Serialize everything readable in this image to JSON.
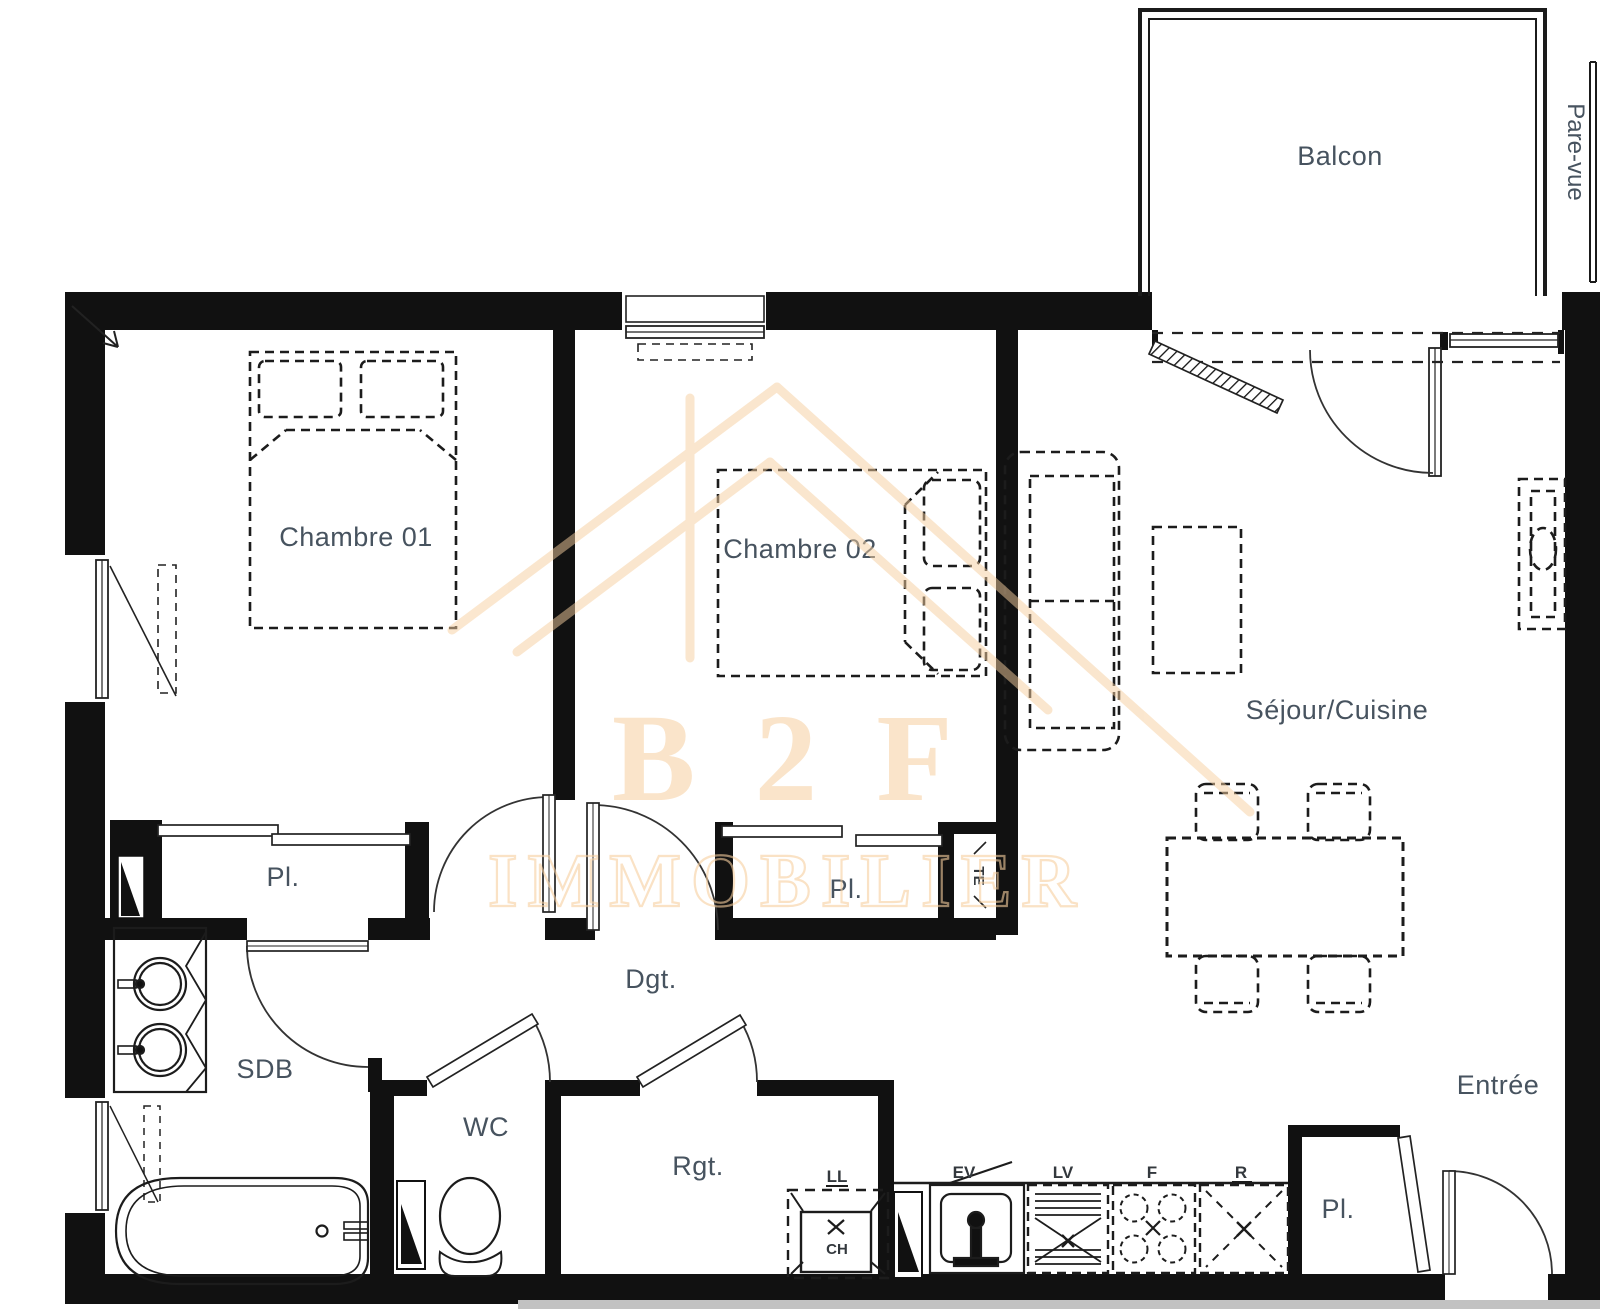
{
  "colors": {
    "wall": "#111111",
    "line": "#2c2c2c",
    "label": "#47535f",
    "small_label": "#33383d",
    "watermark": "#f7cf9f",
    "page_edge": "#c2c2c2",
    "background": "#ffffff"
  },
  "rooms": {
    "balcony": {
      "label": "Balcon"
    },
    "screen": {
      "label": "Pare-vue"
    },
    "bedroom1": {
      "label": "Chambre 01"
    },
    "bedroom2": {
      "label": "Chambre 02"
    },
    "living_kitchen": {
      "label": "Séjour/Cuisine"
    },
    "closet_bedroom1": {
      "label": "Pl."
    },
    "closet_bedroom2": {
      "label": "Pl."
    },
    "closet_entry": {
      "label": "Pl."
    },
    "hallway": {
      "label": "Dgt."
    },
    "bathroom": {
      "label": "SDB"
    },
    "wc": {
      "label": "WC"
    },
    "storage": {
      "label": "Rgt."
    },
    "entry": {
      "label": "Entrée"
    },
    "electrical": {
      "label": "TE"
    }
  },
  "appliances": {
    "washing_machine": "LL",
    "water_heater": "CH",
    "kitchen_sink": "EV",
    "dishwasher": "LV",
    "stove": "F",
    "fridge": "R"
  },
  "watermark": {
    "brand": "B 2 F",
    "tagline": "IMMOBILIER"
  }
}
